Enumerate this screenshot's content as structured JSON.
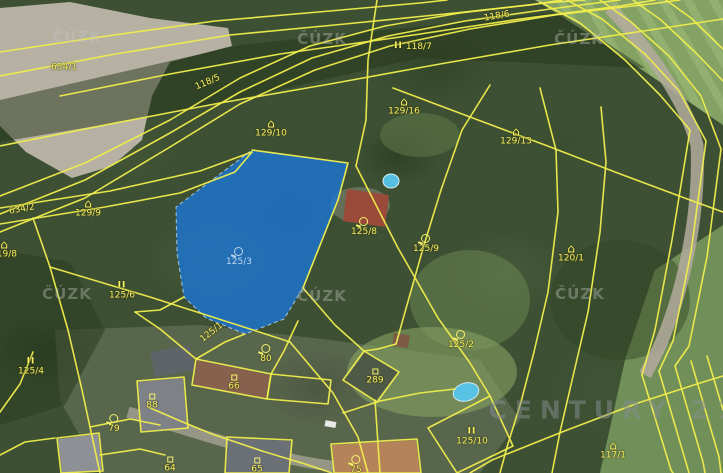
{
  "map": {
    "colors": {
      "boundary_yellow": "#f0ed4d",
      "label_yellow": "#f6f06b",
      "highlight_blue": "rgba(28,118,212,0.8)",
      "watermark_grey": "rgba(195,200,195,0.38)"
    },
    "watermarks": {
      "cuzk": {
        "text": "ČÚZK",
        "positions": [
          {
            "x": 77,
            "y": 37
          },
          {
            "x": 322,
            "y": 39
          },
          {
            "x": 579,
            "y": 39
          },
          {
            "x": 67,
            "y": 294
          },
          {
            "x": 322,
            "y": 296
          },
          {
            "x": 580,
            "y": 294
          }
        ]
      },
      "brand": {
        "text": "CENTURY 21",
        "x": 615,
        "y": 410
      }
    },
    "highlighted_parcel": {
      "number": "125/3",
      "points": "252,150 348,163 338,200 303,288 284,319 245,334 206,318 184,297 177,253 176,207"
    },
    "labels": [
      {
        "text": "634/1",
        "x": 64,
        "y": 68,
        "icon": "none",
        "rot": 0
      },
      {
        "text": "118/5",
        "x": 208,
        "y": 83,
        "icon": "none",
        "rot": -23
      },
      {
        "text": "118/7",
        "x": 413,
        "y": 47,
        "icon": "meadow",
        "rot": 0,
        "iconSide": "left"
      },
      {
        "text": "118/6",
        "x": 497,
        "y": 17,
        "icon": "none",
        "rot": -10
      },
      {
        "text": "129/10",
        "x": 271,
        "y": 129,
        "icon": "house",
        "rot": 0
      },
      {
        "text": "129/16",
        "x": 404,
        "y": 107,
        "icon": "house",
        "rot": 0
      },
      {
        "text": "129/13",
        "x": 516,
        "y": 137,
        "icon": "house",
        "rot": 0
      },
      {
        "text": "129/9",
        "x": 88,
        "y": 209,
        "icon": "house",
        "rot": 0
      },
      {
        "text": "634/2",
        "x": 22,
        "y": 210,
        "icon": "none",
        "rot": -10
      },
      {
        "text": "119/8",
        "x": 4,
        "y": 250,
        "icon": "house",
        "rot": 0
      },
      {
        "text": "125/6",
        "x": 122,
        "y": 291,
        "icon": "meadow",
        "rot": 0
      },
      {
        "text": "125/8",
        "x": 364,
        "y": 227,
        "icon": "orchard",
        "rot": 0
      },
      {
        "text": "125/9",
        "x": 426,
        "y": 244,
        "icon": "orchard",
        "rot": 0
      },
      {
        "text": "120/1",
        "x": 571,
        "y": 254,
        "icon": "house",
        "rot": 0
      },
      {
        "text": "125/3",
        "x": 239,
        "y": 257,
        "icon": "orchard",
        "rot": 0,
        "variant": "on-blue"
      },
      {
        "text": "125/4",
        "x": 31,
        "y": 367,
        "icon": "meadow",
        "rot": 0
      },
      {
        "text": "125/1",
        "x": 212,
        "y": 333,
        "icon": "none",
        "rot": -38
      },
      {
        "text": "80",
        "x": 266,
        "y": 354,
        "icon": "orchard",
        "rot": 0
      },
      {
        "text": "66",
        "x": 234,
        "y": 383,
        "icon": "square",
        "rot": 0
      },
      {
        "text": "289",
        "x": 375,
        "y": 377,
        "icon": "square",
        "rot": 0
      },
      {
        "text": "88",
        "x": 152,
        "y": 402,
        "icon": "square",
        "rot": 0
      },
      {
        "text": "79",
        "x": 114,
        "y": 424,
        "icon": "orchard",
        "rot": 0
      },
      {
        "text": "64",
        "x": 170,
        "y": 465,
        "icon": "square",
        "rot": 0
      },
      {
        "text": "65",
        "x": 257,
        "y": 466,
        "icon": "square",
        "rot": 0
      },
      {
        "text": "75",
        "x": 356,
        "y": 465,
        "icon": "orchard",
        "rot": 0
      },
      {
        "text": "125/10",
        "x": 472,
        "y": 437,
        "icon": "meadow",
        "rot": 0
      },
      {
        "text": "125/2",
        "x": 461,
        "y": 340,
        "icon": "orchard",
        "rot": 0
      },
      {
        "text": "117/1",
        "x": 613,
        "y": 451,
        "icon": "house",
        "rot": 0
      }
    ],
    "boundaries": [
      "0,52 100,37 215,21 330,11 420,3 447,0",
      "0,76 110,55 230,35 345,24 455,13 530,5 562,0",
      "0,196 85,163 170,120 240,78 310,46 385,26 460,13 545,3 585,0",
      "0,214 85,180 170,133 240,92 312,58 388,36 465,21 550,9 620,0",
      "0,232 85,198 170,147 240,104 315,70 390,46 470,29 555,15 650,4 680,0",
      "60,96 170,74 280,54 400,37 520,19 620,6 655,0",
      "0,146 110,124 220,103 330,84 440,64 550,45 650,30 723,19",
      "0,208 110,191 200,171 252,152",
      "0,224 105,207 180,193 235,172 252,152",
      "33,218 50,267 68,330 82,390 90,427 100,473",
      "50,267 150,297 250,329 290,342",
      "290,342 333,393 358,437 368,473",
      "196,359 225,342 245,334",
      "135,312 160,329 196,359",
      "271,374 284,351 298,321",
      "303,288 335,325 364,351",
      "377,0 368,60 366,120 356,166",
      "356,166 398,248 438,318 470,363 490,396",
      "393,88 470,117 545,145 615,172 690,200 723,212",
      "490,85 462,130 441,190 424,245 407,305 396,344",
      "540,88 556,150 558,212 548,292 534,352 521,402 507,447 500,473",
      "601,107 606,162 600,232 588,312 574,372 560,432 552,473",
      "540,2 580,23 625,60 660,95 690,130 672,240 655,330 642,375",
      "567,0 602,19 646,55 679,91 706,141 691,252 673,341 659,371",
      "600,0 631,22 669,56 701,96 721,149 707,257 689,346 675,366",
      "633,0 661,20 696,53 723,81",
      "666,0 691,18 723,49",
      "470,473 492,460 562,432 638,403 700,383 723,376",
      "642,375 671,470 673,473",
      "659,371 687,466 689,473",
      "675,366 703,462 705,473",
      "691,361 719,457 721,473",
      "707,356 723,410",
      "148,407 178,420 212,434 262,451 305,464 332,473",
      "90,427 130,419 160,425",
      "100,455 140,449 165,455",
      "375,400 380,473",
      "343,413 380,401 420,393 455,389",
      "428,428 490,396 513,446 457,473 428,428",
      "396,344 378,349 364,351",
      "184,297 160,310 135,312",
      "0,412 20,384 33,352",
      "0,455 25,442 55,438",
      "252,150 348,163 338,200 303,288"
    ],
    "buildings": [
      "196,359 271,374 267,399 192,385",
      "271,374 331,380 328,404 267,399",
      "364,351 399,372 377,402 343,380",
      "137,381 184,377 188,428 141,432",
      "227,437 292,440 289,473 225,473",
      "331,444 417,439 421,473 334,473",
      "57,438 99,433 103,471 61,473"
    ]
  }
}
